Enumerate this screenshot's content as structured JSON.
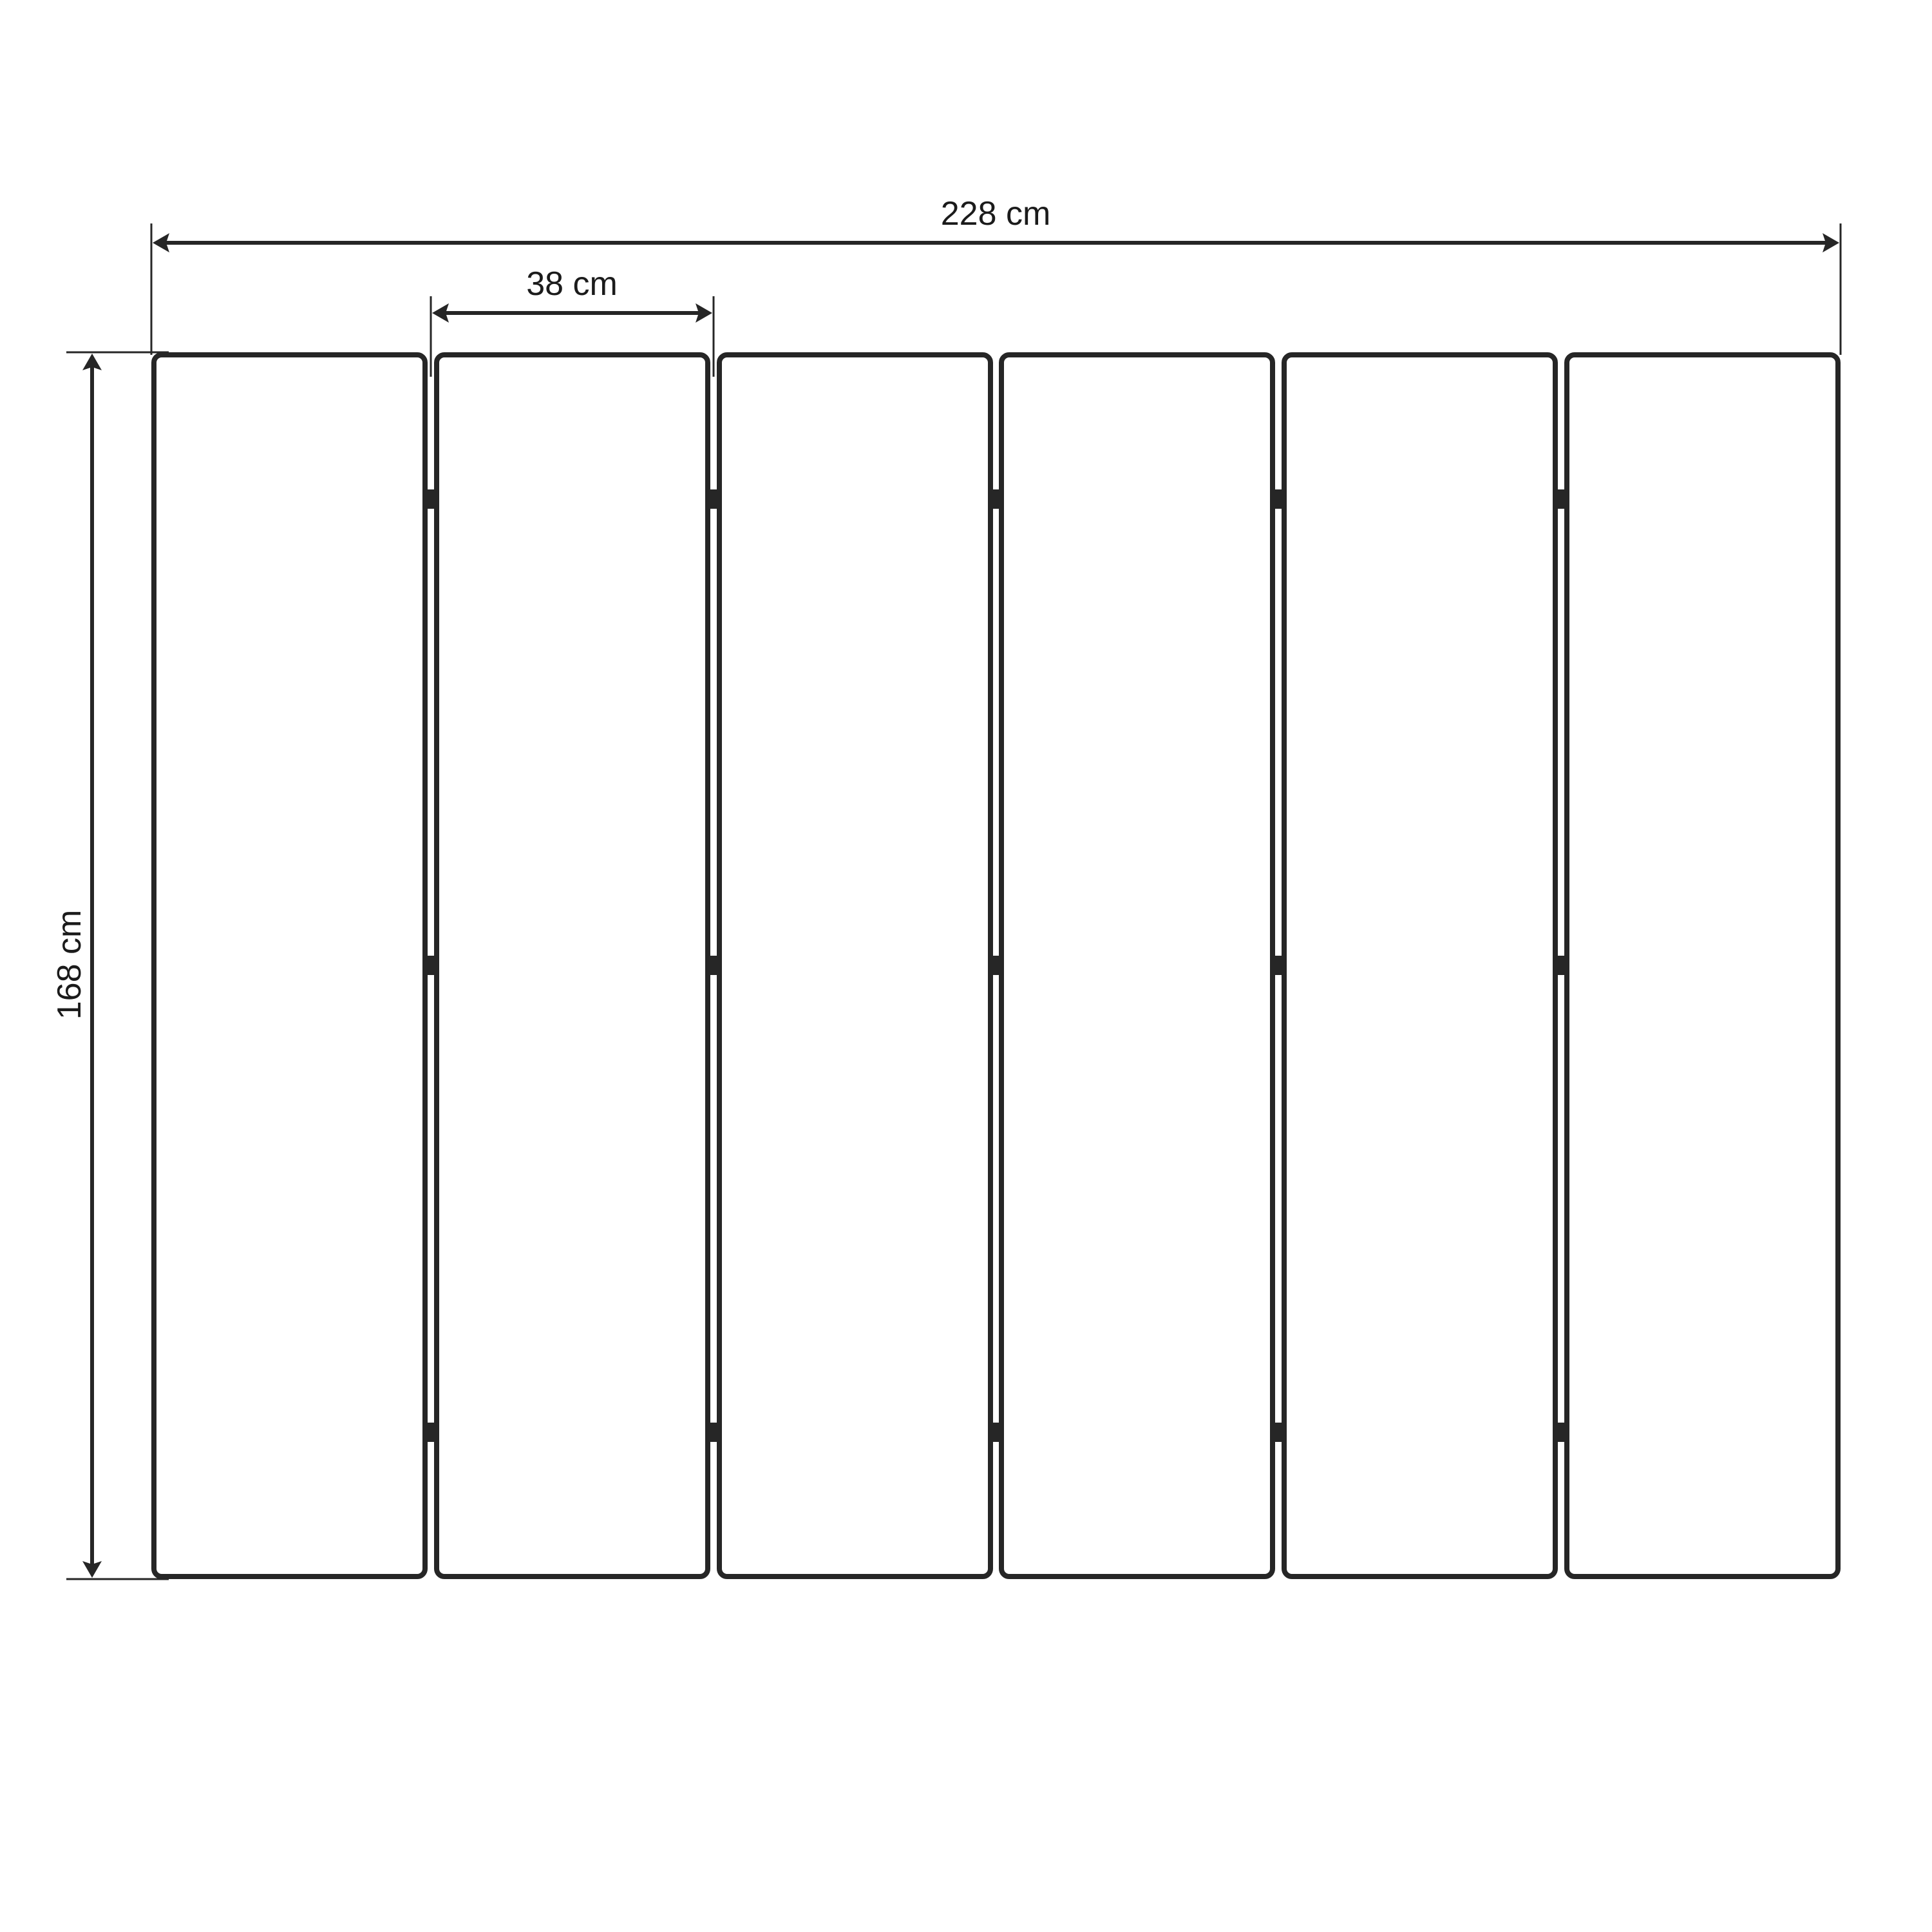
{
  "diagram": {
    "description": "Dimensioned technical drawing of a six-panel folding screen / slatted unit",
    "panel_count": 6,
    "gaps_between_panels": 5,
    "hinge_marks_per_gap": 3,
    "labels": {
      "total_width": "228 cm",
      "panel_width": "38 cm",
      "height": "168 cm"
    },
    "values": {
      "total_width_cm": 228,
      "panel_width_cm": 38,
      "height_cm": 168
    },
    "colors": {
      "line": "#262626",
      "text": "#1b1b1b",
      "background": "#ffffff"
    }
  }
}
